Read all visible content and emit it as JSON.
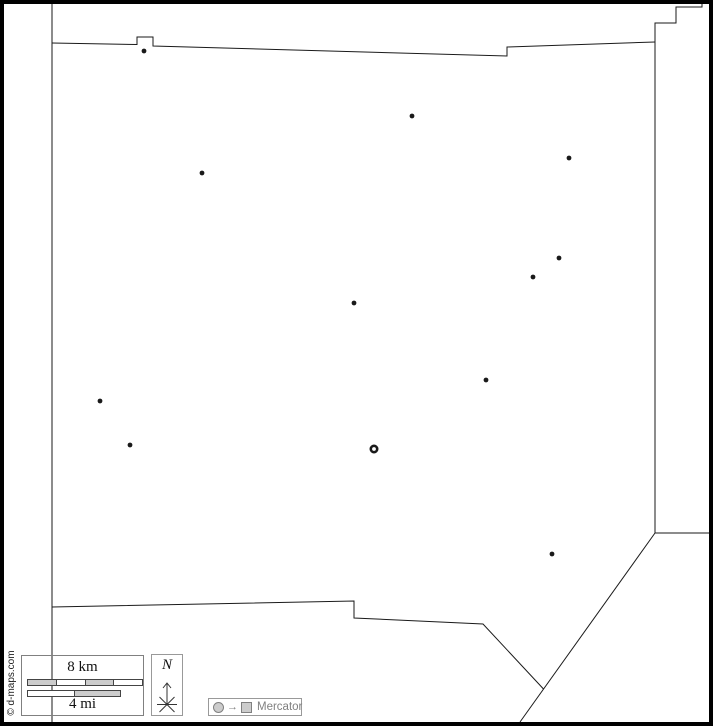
{
  "map": {
    "copyright": "© d-maps.com",
    "scale_bar": {
      "km_label": "8 km",
      "mi_label": "4 mi"
    },
    "compass": {
      "north_label": "N"
    },
    "legend": {
      "projection": "Mercator",
      "arrow_glyph": "→"
    },
    "markers": [
      {
        "x": 144,
        "y": 51,
        "type": "town"
      },
      {
        "x": 412,
        "y": 116,
        "type": "town"
      },
      {
        "x": 569,
        "y": 158,
        "type": "town"
      },
      {
        "x": 202,
        "y": 173,
        "type": "town"
      },
      {
        "x": 559,
        "y": 258,
        "type": "town"
      },
      {
        "x": 533,
        "y": 277,
        "type": "town"
      },
      {
        "x": 354,
        "y": 303,
        "type": "town"
      },
      {
        "x": 486,
        "y": 380,
        "type": "town"
      },
      {
        "x": 100,
        "y": 401,
        "type": "town"
      },
      {
        "x": 130,
        "y": 445,
        "type": "town"
      },
      {
        "x": 374,
        "y": 449,
        "type": "county-seat"
      },
      {
        "x": 552,
        "y": 554,
        "type": "town"
      }
    ]
  },
  "colors": {
    "boundary_line": "#1a1a1a",
    "frame": "#000000",
    "scale_fill_gray": "#cccccc",
    "legend_gray": "#808080"
  }
}
